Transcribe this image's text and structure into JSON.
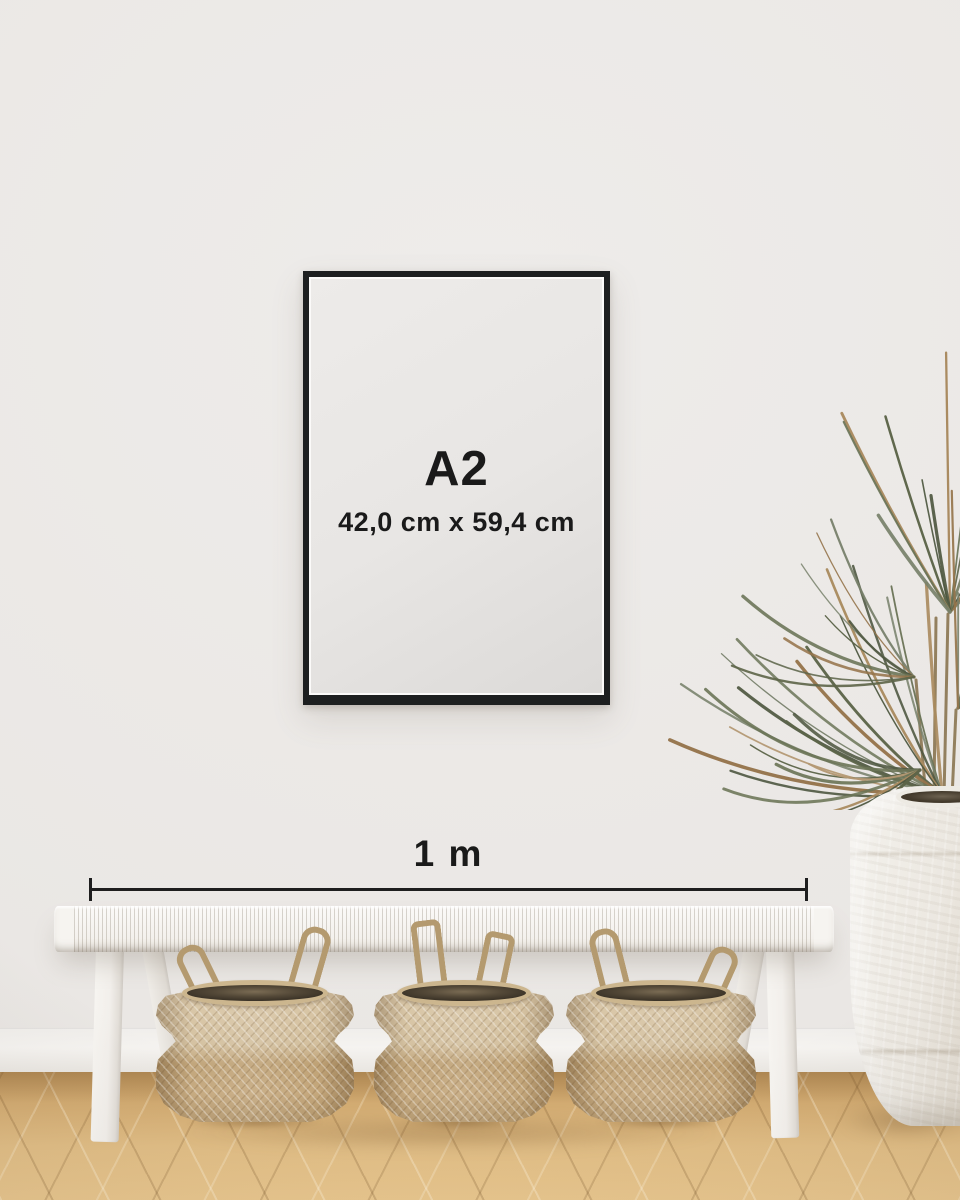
{
  "labels": {
    "frame_size": "A2",
    "frame_dimensions": "42,0 cm x 59,4 cm",
    "scale": "1 m"
  },
  "colors": {
    "wall": "#eeecea",
    "baseboard": "#f5f3f0",
    "floor_light": "#e0bd85",
    "floor_dark": "#c79d63",
    "frame": "#1d1f20",
    "poster": "#e8e6e4",
    "text": "#1a1a1a",
    "bench": "#f4f1ed",
    "basket_light": "#d0bb97",
    "basket_dark": "#bb9c6d",
    "vase": "#ece8e1",
    "plant_greens": [
      "#5d6549",
      "#6b7457",
      "#4e5740",
      "#78816b"
    ],
    "plant_browns": [
      "#a98a5f",
      "#b49873",
      "#95744b"
    ]
  }
}
